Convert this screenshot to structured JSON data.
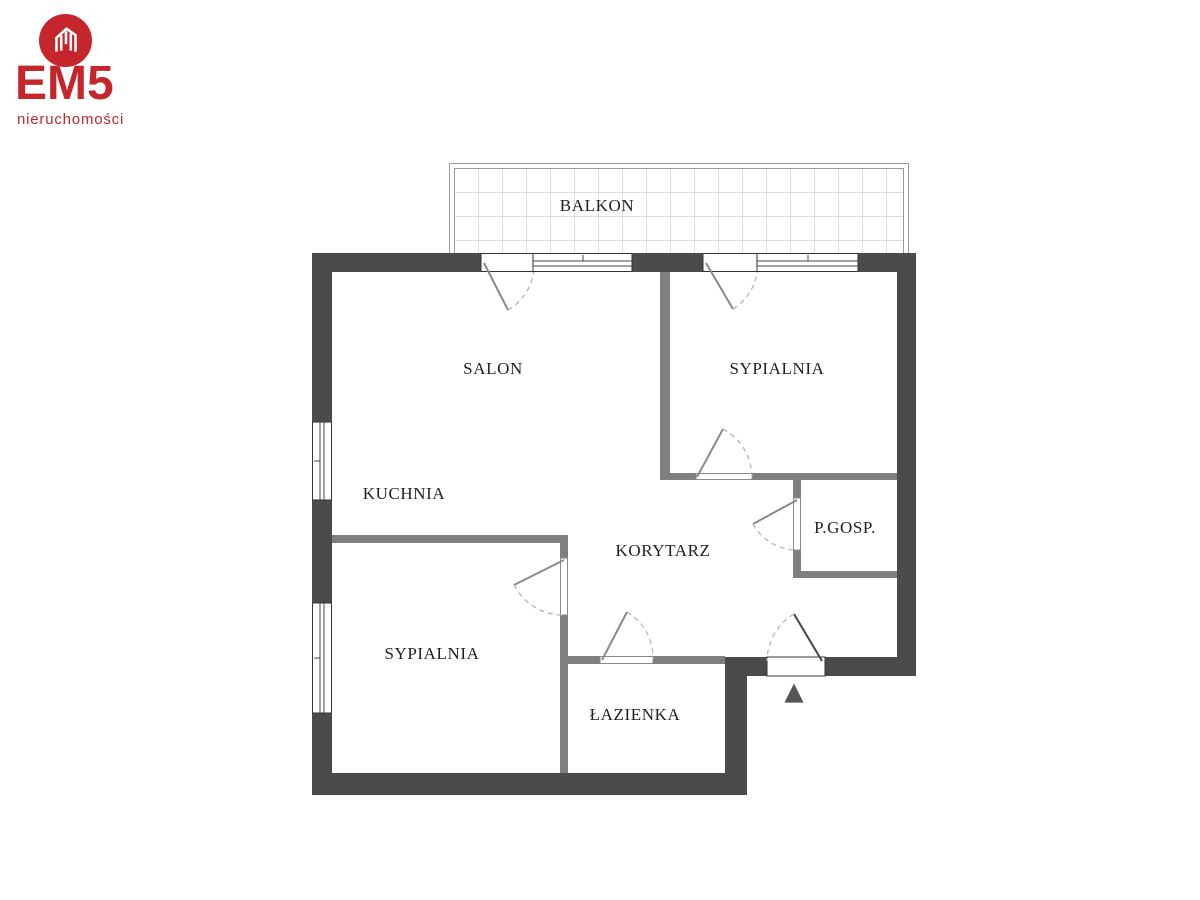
{
  "logo": {
    "brand": "EM5",
    "subtitle": "nieruchomości",
    "color": "#c4262c"
  },
  "icons": {
    "entrance_arrow": "▲",
    "brand_house_icon": "house-in-circle"
  },
  "floor_plan": {
    "colors": {
      "exterior_wall": "#4b4b4b",
      "interior_wall": "#7f7f7f",
      "balcony_grid_line": "#dcdcdc",
      "balcony_border": "#9a9a9a",
      "door_leaf": "#8a8a8a",
      "door_arc": "#b0b0b0",
      "label_text": "#1f1f1f"
    },
    "rooms": [
      {
        "name": "BALKON"
      },
      {
        "name": "SALON"
      },
      {
        "name": "SYPIALNIA"
      },
      {
        "name": "KUCHNIA"
      },
      {
        "name": "KORYTARZ"
      },
      {
        "name": "P.GOSP."
      },
      {
        "name": "SYPIALNIA"
      },
      {
        "name": "ŁAZIENKA"
      }
    ]
  }
}
